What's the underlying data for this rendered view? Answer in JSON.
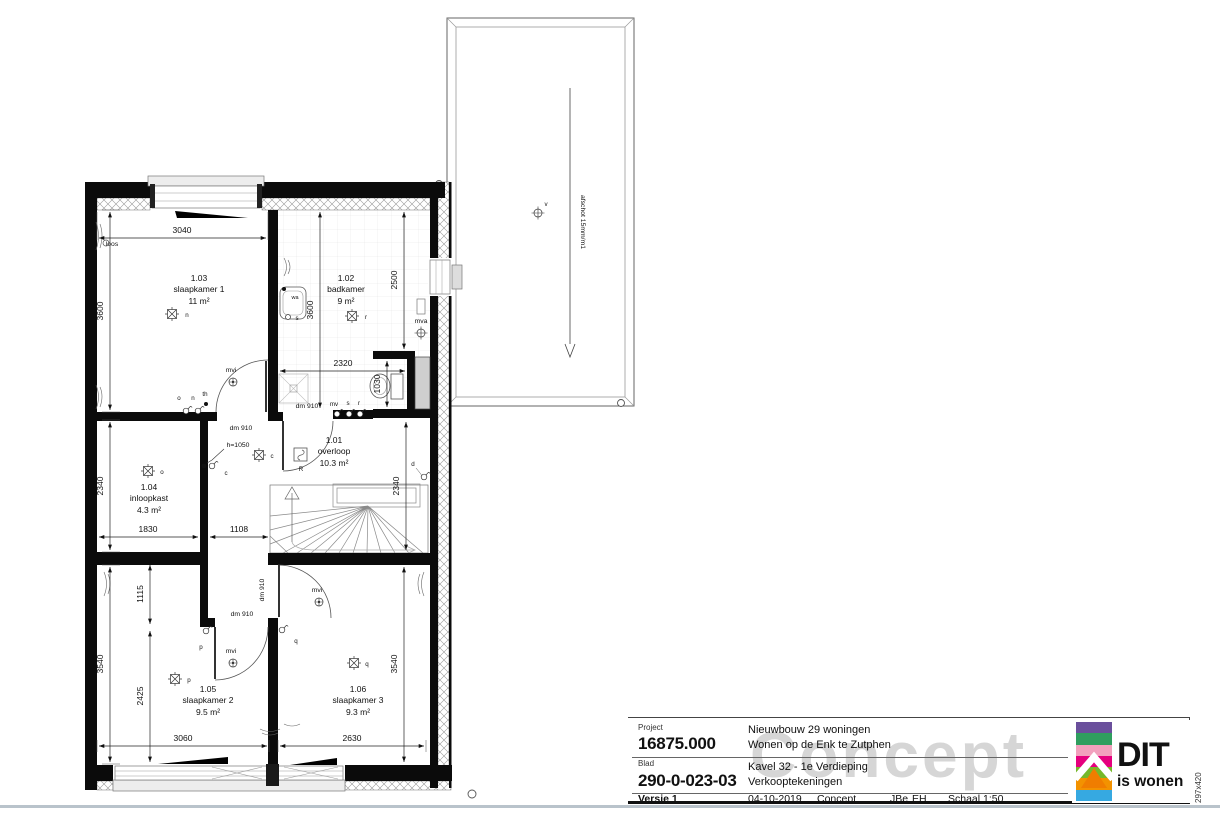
{
  "sheet": {
    "watermark": "Concept",
    "paper_size": "297x420"
  },
  "title_block": {
    "project_label": "Project",
    "project_number": "16875.000",
    "project_line1": "Nieuwbouw 29 woningen",
    "project_line2": "Wonen op de Enk te Zutphen",
    "blad_label": "Blad",
    "blad_number": "290-0-023-03",
    "blad_line1": "Kavel 32 - 1e Verdieping",
    "blad_line2": "Verkooptekeningen",
    "versie": "Versie 1",
    "date": "04-10-2019",
    "status": "Concept",
    "drawn_by": "JBe",
    "checked_by": "EH",
    "scale": "Schaal 1:50"
  },
  "logo": {
    "main": "DIT",
    "sub": "is wonen",
    "stripe_colors": [
      "#6a4f9c",
      "#2f9e5f",
      "#f2a0bd",
      "#e5007e",
      "#76b82a",
      "#f39200",
      "#36a9e1"
    ],
    "house_color": "#f07d00"
  },
  "rooms": {
    "overloop": {
      "number": "1.01",
      "name": "overloop",
      "area": "10.3 m²"
    },
    "badkamer": {
      "number": "1.02",
      "name": "badkamer",
      "area": "9 m²"
    },
    "slaapkamer1": {
      "number": "1.03",
      "name": "slaapkamer 1",
      "area": "11 m²"
    },
    "inloopkast": {
      "number": "1.04",
      "name": "inloopkast",
      "area": "4.3 m²"
    },
    "slaapkamer2": {
      "number": "1.05",
      "name": "slaapkamer 2",
      "area": "9.5 m²"
    },
    "slaapkamer3": {
      "number": "1.06",
      "name": "slaapkamer 3",
      "area": "9.3 m²"
    }
  },
  "dims": {
    "top_width": "3040",
    "sk1_height": "3600",
    "badkamer_height": "3600",
    "badkamer_right": "2500",
    "badkamer_width": "2320",
    "toilet_niche": "1030",
    "overloop_right": "2340",
    "inloopkast_height": "2340",
    "inloopkast_width": "1830",
    "hall_width": "1108",
    "corridor": "1115",
    "sk2_height": "3540",
    "sk2_inner": "2425",
    "sk2_width": "3060",
    "sk3_width": "2630",
    "sk3_height": "3540"
  },
  "ann": {
    "afschot": "afschot 15mm/m1",
    "dm910": "dm 910",
    "h1050": "h=1050",
    "mvi": "mvi",
    "mva": "mva",
    "loos": "loos",
    "smoke": "R",
    "vent": "v",
    "wa": "wa"
  },
  "letters": {
    "c": "c",
    "d": "d",
    "n": "n",
    "o": "o",
    "p": "p",
    "q": "q",
    "r": "r",
    "s": "s",
    "th": "th",
    "mv": "mv"
  }
}
